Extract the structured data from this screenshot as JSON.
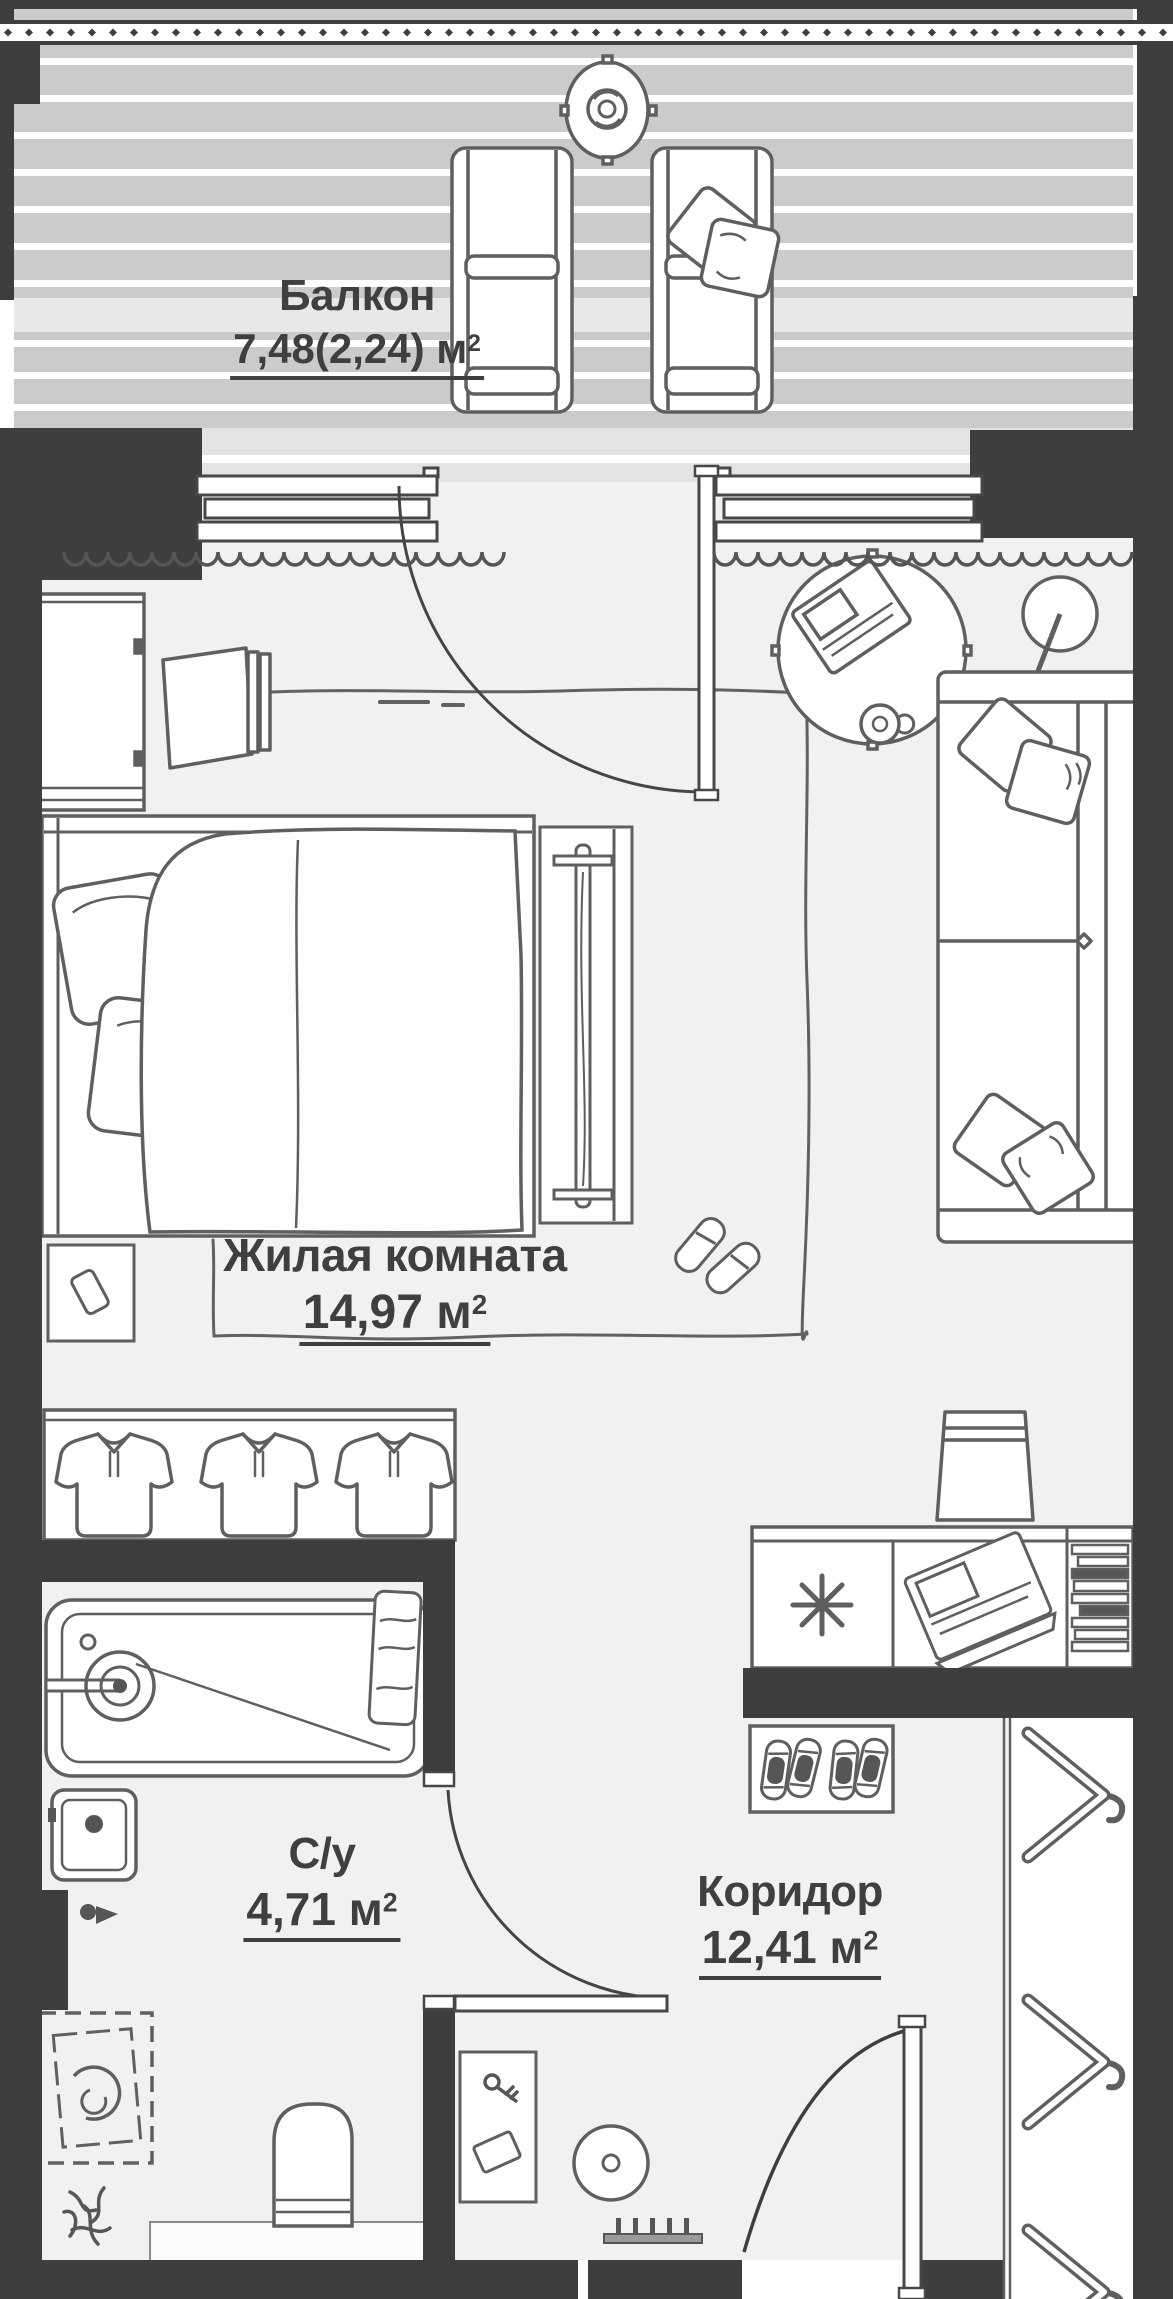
{
  "title": "Floor plan of studio apartment",
  "colors": {
    "wall": "#3e3e3e",
    "deck": "#cbcbcb",
    "deck_stripe": "#ffffff",
    "threshold": "#e8e8e8",
    "facade_band": "#e3e3e3",
    "room_floor": "#f1f1f1",
    "furniture_stroke": "#5f5f5f",
    "text": "#3f3f3f"
  },
  "rooms": [
    {
      "id": "balcony",
      "name": "Балкон",
      "area": "7,48(2,24) м",
      "sup": "2"
    },
    {
      "id": "living",
      "name": "Жилая комната",
      "area": "14,97 м",
      "sup": "2"
    },
    {
      "id": "bathroom",
      "name": "С/у",
      "area": "4,71 м",
      "sup": "2"
    },
    {
      "id": "corridor",
      "name": "Коридор",
      "area": "12,41 м",
      "sup": "2"
    }
  ],
  "furniture": [
    "balcony-railing",
    "balcony-round-table",
    "balcony-plant",
    "lounge-chair",
    "chair-pillow",
    "window",
    "balcony-door",
    "curtain",
    "tall-wardrobe",
    "tv",
    "bed",
    "bed-pillow",
    "blanket",
    "nightstand",
    "phone",
    "radiator-bench",
    "area-rug",
    "slippers",
    "round-coffee-table",
    "laptop",
    "cup",
    "floor-lamp",
    "sofa",
    "sofa-pillow",
    "clothes-rack",
    "polo-shirt",
    "desk",
    "cooktop-asterisk",
    "open-laptop",
    "books",
    "bar-stool",
    "shoe-mat",
    "sneaker",
    "hallway-wardrobe",
    "hanger",
    "console-table",
    "keys",
    "card",
    "entry-rug",
    "boot-dryer",
    "entrance-door",
    "bathroom-door",
    "bathtub",
    "faucet",
    "towel",
    "sink",
    "tap-valve",
    "washing-machine",
    "plant-sketch",
    "toilet",
    "floor-step"
  ]
}
